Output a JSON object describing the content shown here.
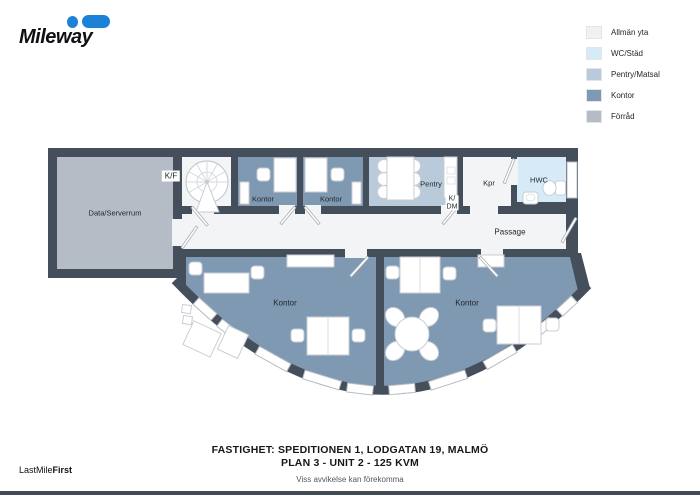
{
  "brand": {
    "logo_text": "Mileway",
    "blue": "#1c82d8",
    "tagline": {
      "regular": "LastMile",
      "bold": "First"
    }
  },
  "legend": {
    "items": [
      {
        "label": "Allmän yta",
        "color": "#eff1f3"
      },
      {
        "label": "WC/Städ",
        "color": "#d6eaf7"
      },
      {
        "label": "Pentry/Matsal",
        "color": "#b9cada"
      },
      {
        "label": "Kontor",
        "color": "#7f99b3"
      },
      {
        "label": "Förråd",
        "color": "#b5bcc6"
      }
    ]
  },
  "floorplan": {
    "colors": {
      "wall": "#454f5b",
      "allman": "#f3f4f6",
      "wc": "#d6eaf7",
      "pentry": "#b9cada",
      "kontor": "#7f99b3",
      "forrad": "#b5bcc6"
    },
    "labels": {
      "data_serverrum": "Data/Serverrum",
      "kf": "K/F",
      "kontor_small_left": "Kontor",
      "kontor_small_right": "Kontor",
      "pentry": "Pentry",
      "kdm_top": "K/",
      "kdm_bottom": "DM",
      "kpr": "Kpr",
      "hwc": "HWC",
      "passage": "Passage",
      "kontor_large_left": "Kontor",
      "kontor_large_right": "Kontor"
    }
  },
  "footer": {
    "line1": "FASTIGHET: SPEDITIONEN 1, LODGATAN 19, MALMÖ",
    "line2": "PLAN 3 - UNIT 2 - 125 KVM",
    "disclaimer": "Viss avvikelse kan förekomma"
  }
}
